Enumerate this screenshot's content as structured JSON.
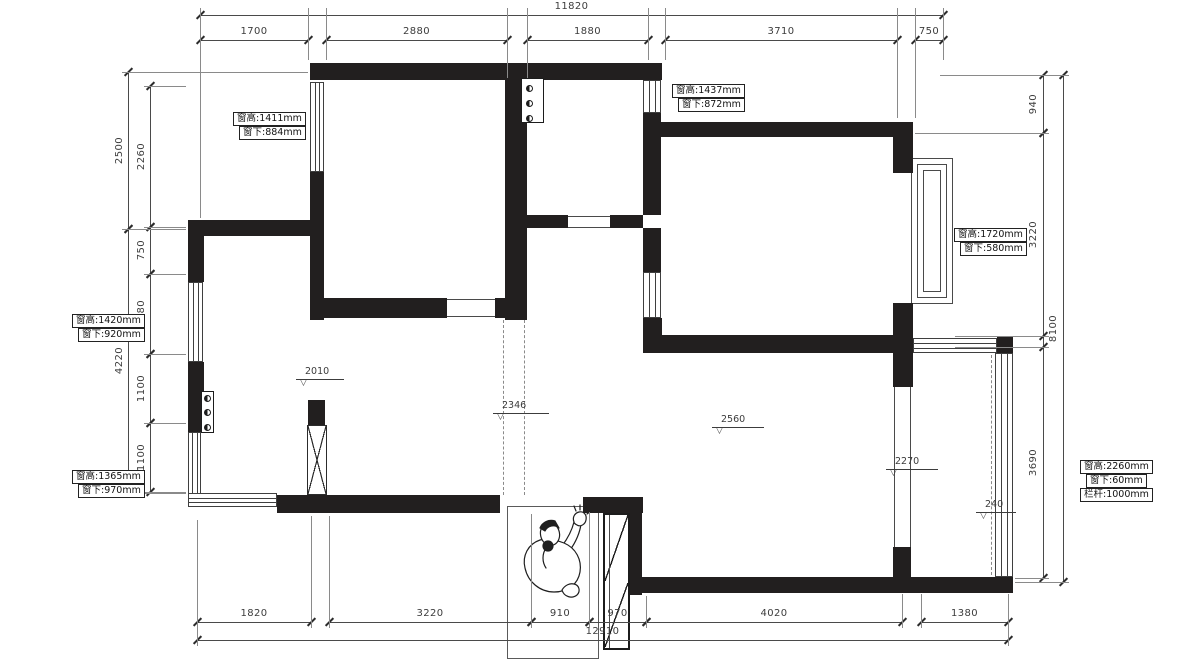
{
  "title": "apartment floor plan with window specifications",
  "colors": {
    "wall": "#221f1f",
    "thin_line": "#4a4a4a",
    "dim_text": "#3c3c3c",
    "background": "#ffffff"
  },
  "window_labels": [
    {
      "lines": [
        "窗高:1411mm",
        "窗下:884mm"
      ],
      "x": 233,
      "y": 112
    },
    {
      "lines": [
        "窗高:1437mm",
        "窗下:872mm"
      ],
      "x": 672,
      "y": 84
    },
    {
      "lines": [
        "窗高:1720mm",
        "窗下:580mm"
      ],
      "x": 954,
      "y": 228
    },
    {
      "lines": [
        "窗高:1420mm",
        "窗下:920mm"
      ],
      "x": 72,
      "y": 314
    },
    {
      "lines": [
        "窗高:1365mm",
        "窗下:970mm"
      ],
      "x": 72,
      "y": 470
    },
    {
      "lines": [
        "窗高:2260mm",
        "窗下:60mm",
        "栏杆:1000mm"
      ],
      "x": 1080,
      "y": 460
    }
  ],
  "level_markers": [
    {
      "value": "2010",
      "x": 296,
      "y": 379,
      "len": 48
    },
    {
      "value": "2346",
      "x": 493,
      "y": 413,
      "len": 56
    },
    {
      "value": "2560",
      "x": 712,
      "y": 427,
      "len": 52
    },
    {
      "value": "2270",
      "x": 886,
      "y": 469,
      "len": 52
    },
    {
      "value": "240",
      "x": 976,
      "y": 512,
      "len": 40
    }
  ],
  "dimensions": {
    "top": {
      "total": {
        "label": "11820",
        "y": 15,
        "x1": 200,
        "x2": 943
      },
      "chain_y": 40,
      "segments": [
        {
          "label": "1700",
          "x1": 200,
          "x2": 308
        },
        {
          "label": "2880",
          "x1": 326,
          "x2": 507
        },
        {
          "label": "1880",
          "x1": 527,
          "x2": 648
        },
        {
          "label": "3710",
          "x1": 665,
          "x2": 897
        },
        {
          "label": "750",
          "x1": 915,
          "x2": 943
        }
      ]
    },
    "bottom": {
      "total": {
        "label": "12910",
        "y": 640,
        "x1": 197,
        "x2": 1008
      },
      "chain_y": 622,
      "segments": [
        {
          "label": "1820",
          "x1": 197,
          "x2": 311
        },
        {
          "label": "3220",
          "x1": 329,
          "x2": 531
        },
        {
          "label": "910",
          "x1": 531,
          "x2": 589
        },
        {
          "label": "970",
          "x1": 589,
          "x2": 646
        },
        {
          "label": "4020",
          "x1": 646,
          "x2": 902
        },
        {
          "label": "1380",
          "x1": 921,
          "x2": 1008
        }
      ]
    },
    "left": {
      "outer_x": 128,
      "outer_label_x": 112,
      "outer": [
        {
          "label": "2500",
          "y1": 72,
          "y2": 229
        },
        {
          "label": "4220",
          "y1": 229,
          "y2": 493
        }
      ],
      "inner_x": 150,
      "inner_label_x": 134,
      "inner": [
        {
          "label": "2260",
          "y1": 86,
          "y2": 227
        },
        {
          "label": "750",
          "y1": 227,
          "y2": 274
        },
        {
          "label": "1280",
          "y1": 274,
          "y2": 354
        },
        {
          "label": "1100",
          "y1": 354,
          "y2": 423
        },
        {
          "label": "1100",
          "y1": 423,
          "y2": 492
        }
      ]
    },
    "right": {
      "inner_x": 1043,
      "inner_label_x": 1026,
      "inner": [
        {
          "label": "940",
          "y1": 75,
          "y2": 133
        },
        {
          "label": "3220",
          "y1": 133,
          "y2": 336
        },
        {
          "label": "3690",
          "y1": 347,
          "y2": 578
        }
      ],
      "outer_x": 1063,
      "outer_label_x": 1046,
      "outer": [
        {
          "label": "8100",
          "y1": 75,
          "y2": 582
        }
      ]
    },
    "extensions": {
      "v": [
        [
          200,
          8,
          218
        ],
        [
          308,
          8,
          60
        ],
        [
          326,
          8,
          60
        ],
        [
          507,
          8,
          78
        ],
        [
          527,
          8,
          78
        ],
        [
          648,
          8,
          60
        ],
        [
          665,
          8,
          60
        ],
        [
          897,
          8,
          118
        ],
        [
          915,
          8,
          118
        ],
        [
          943,
          8,
          60
        ],
        [
          197,
          520,
          646
        ],
        [
          311,
          516,
          628
        ],
        [
          329,
          516,
          628
        ],
        [
          531,
          514,
          628
        ],
        [
          589,
          512,
          628
        ],
        [
          646,
          596,
          628
        ],
        [
          902,
          594,
          628
        ],
        [
          921,
          594,
          628
        ],
        [
          1008,
          594,
          646
        ]
      ],
      "h": [
        [
          72,
          122,
          308
        ],
        [
          229,
          122,
          186
        ],
        [
          493,
          122,
          186
        ],
        [
          86,
          144,
          186
        ],
        [
          227,
          144,
          186
        ],
        [
          274,
          144,
          186
        ],
        [
          354,
          144,
          186
        ],
        [
          423,
          144,
          186
        ],
        [
          492,
          144,
          186
        ],
        [
          75,
          940,
          1069
        ],
        [
          133,
          915,
          1049
        ],
        [
          336,
          955,
          1049
        ],
        [
          347,
          955,
          1049
        ],
        [
          578,
          1015,
          1049
        ],
        [
          582,
          1015,
          1069
        ]
      ]
    }
  },
  "plan": {
    "walls": [
      [
        310,
        63,
        352,
        17
      ],
      [
        310,
        172,
        14,
        148
      ],
      [
        188,
        220,
        122,
        16
      ],
      [
        188,
        236,
        16,
        46
      ],
      [
        188,
        362,
        16,
        70
      ],
      [
        277,
        495,
        223,
        18
      ],
      [
        583,
        497,
        60,
        16
      ],
      [
        628,
        513,
        14,
        82
      ],
      [
        632,
        577,
        381,
        16
      ],
      [
        505,
        80,
        22,
        240
      ],
      [
        323,
        298,
        124,
        20
      ],
      [
        495,
        298,
        32,
        20
      ],
      [
        643,
        113,
        18,
        102
      ],
      [
        523,
        215,
        45,
        13
      ],
      [
        610,
        215,
        33,
        13
      ],
      [
        643,
        228,
        18,
        44
      ],
      [
        643,
        318,
        19,
        35
      ],
      [
        643,
        122,
        270,
        15
      ],
      [
        893,
        137,
        20,
        36
      ],
      [
        893,
        303,
        20,
        84
      ],
      [
        662,
        335,
        231,
        18
      ],
      [
        997,
        337,
        16,
        16
      ],
      [
        893,
        547,
        18,
        30
      ],
      [
        308,
        400,
        17,
        25
      ]
    ],
    "windows": [
      {
        "x": 310,
        "y": 82,
        "w": 14,
        "h": 90,
        "o": "v"
      },
      {
        "x": 188,
        "y": 282,
        "w": 15,
        "h": 80,
        "o": "v"
      },
      {
        "x": 188,
        "y": 432,
        "w": 13,
        "h": 63,
        "o": "v"
      },
      {
        "x": 188,
        "y": 493,
        "w": 89,
        "h": 14,
        "o": "h"
      },
      {
        "x": 643,
        "y": 80,
        "w": 18,
        "h": 33,
        "o": "v"
      },
      {
        "x": 643,
        "y": 272,
        "w": 18,
        "h": 46,
        "o": "v"
      },
      {
        "x": 913,
        "y": 338,
        "w": 84,
        "h": 15,
        "o": "h"
      },
      {
        "x": 995,
        "y": 353,
        "w": 18,
        "h": 224,
        "o": "v"
      }
    ],
    "openings": [
      {
        "o": "h",
        "x1": 447,
        "x2": 495,
        "ya": 299,
        "yb": 316
      },
      {
        "o": "h",
        "x1": 568,
        "x2": 610,
        "ya": 216,
        "yb": 227
      },
      {
        "o": "v",
        "xa": 894,
        "xb": 910,
        "y1": 387,
        "y2": 547
      }
    ],
    "dashed_lines": [
      {
        "x": 503,
        "y1": 320,
        "y2": 495
      },
      {
        "x": 524,
        "y1": 320,
        "y2": 495
      },
      {
        "x": 991,
        "y1": 355,
        "y2": 575
      }
    ],
    "bay": [
      [
        911,
        158,
        42,
        146
      ],
      [
        917,
        164,
        30,
        134
      ],
      [
        923,
        170,
        18,
        122
      ]
    ],
    "risers": [
      {
        "x": 521,
        "y": 78,
        "w": 23,
        "h": 45,
        "circles": [
          [
            526,
            85
          ],
          [
            526,
            100
          ],
          [
            526,
            115
          ]
        ]
      },
      {
        "x": 201,
        "y": 391,
        "w": 13,
        "h": 42,
        "circles": [
          [
            204,
            395
          ],
          [
            204,
            409
          ],
          [
            204,
            424
          ]
        ]
      }
    ],
    "xbox": {
      "x": 307,
      "y": 425,
      "w": 20,
      "h": 70
    },
    "entry_box": {
      "x": 507,
      "y": 506,
      "w": 90,
      "h": 151
    },
    "door": {
      "x": 603,
      "y": 513,
      "w": 27,
      "h": 137,
      "split": 69
    }
  }
}
